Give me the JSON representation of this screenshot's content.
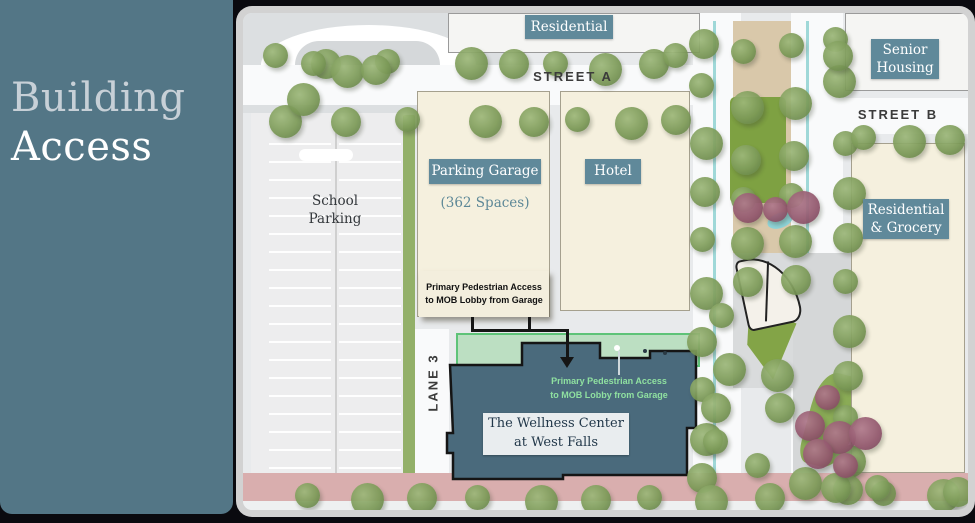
{
  "panel": {
    "title_line1": "Building",
    "title_line2": "Access"
  },
  "map": {
    "streets": {
      "street_a": "STREET A",
      "street_b": "STREET B",
      "lane_3": "LANE 3"
    },
    "labels": {
      "residential": "Residential",
      "senior_housing_lines": [
        "Senior",
        "Housing"
      ],
      "parking_garage": "Parking Garage",
      "parking_garage_capacity": "(362 Spaces)",
      "hotel": "Hotel",
      "school_parking_lines": [
        "School",
        "Parking"
      ],
      "residential_grocery_lines": [
        "Residential",
        "& Grocery"
      ],
      "wellness_center_lines": [
        "The Wellness Center",
        "at West Falls"
      ]
    },
    "annotations": {
      "garage_access_lines": [
        "Primary Pedestrian Access",
        "to MOB Lobby from Garage"
      ],
      "lobby_access_lines": [
        "Primary Pedestrian Access",
        "to MOB Lobby from Garage"
      ]
    },
    "colors": {
      "panel_teal": "#537686",
      "label_box_teal": "#60899a",
      "building_cream": "#f5f0de",
      "wellness_fill": "#4a6a7c",
      "highlight_green": "#5ec378",
      "access_text_green": "#8fe0a0"
    }
  }
}
